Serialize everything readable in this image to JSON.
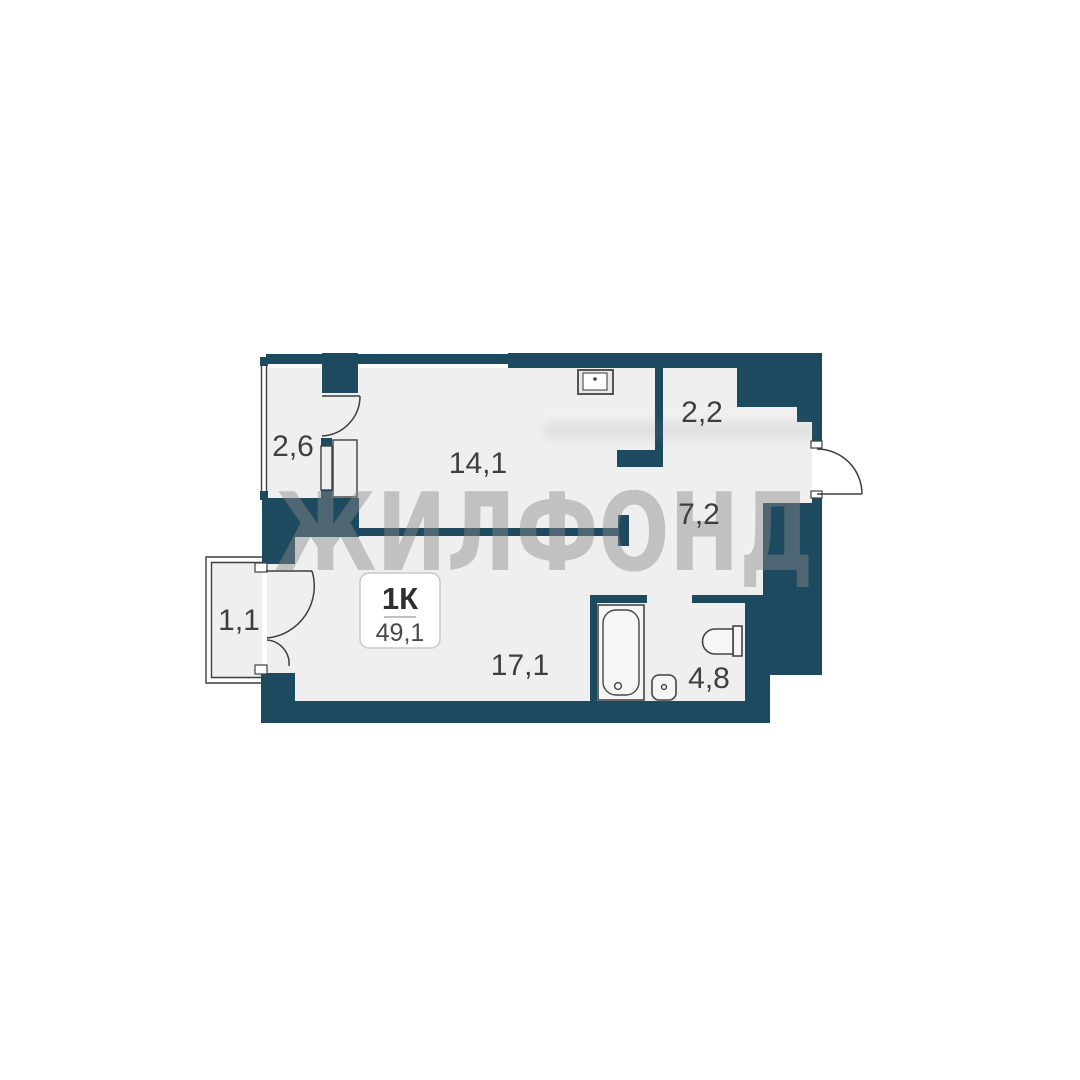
{
  "plan": {
    "watermark_text": "ЖИЛФОНД",
    "unit_label": {
      "type": "1К",
      "total_area": "49,1"
    },
    "rooms": [
      {
        "id": "loggia-top",
        "area": "2,6"
      },
      {
        "id": "kitchen-living",
        "area": "14,1"
      },
      {
        "id": "closet",
        "area": "2,2"
      },
      {
        "id": "hallway",
        "area": "7,2"
      },
      {
        "id": "balcony-bottom",
        "area": "1,1"
      },
      {
        "id": "main-room",
        "area": "17,1"
      },
      {
        "id": "bathroom",
        "area": "4,8"
      }
    ],
    "colors": {
      "wall": "#1d4a5e",
      "floor": "#efefef",
      "outline": "#3f3f3f",
      "watermark": "#8a8a8a",
      "label_text": "#3f3f3f",
      "unit_box_border": "#c9c9c9",
      "background": "#ffffff"
    }
  }
}
